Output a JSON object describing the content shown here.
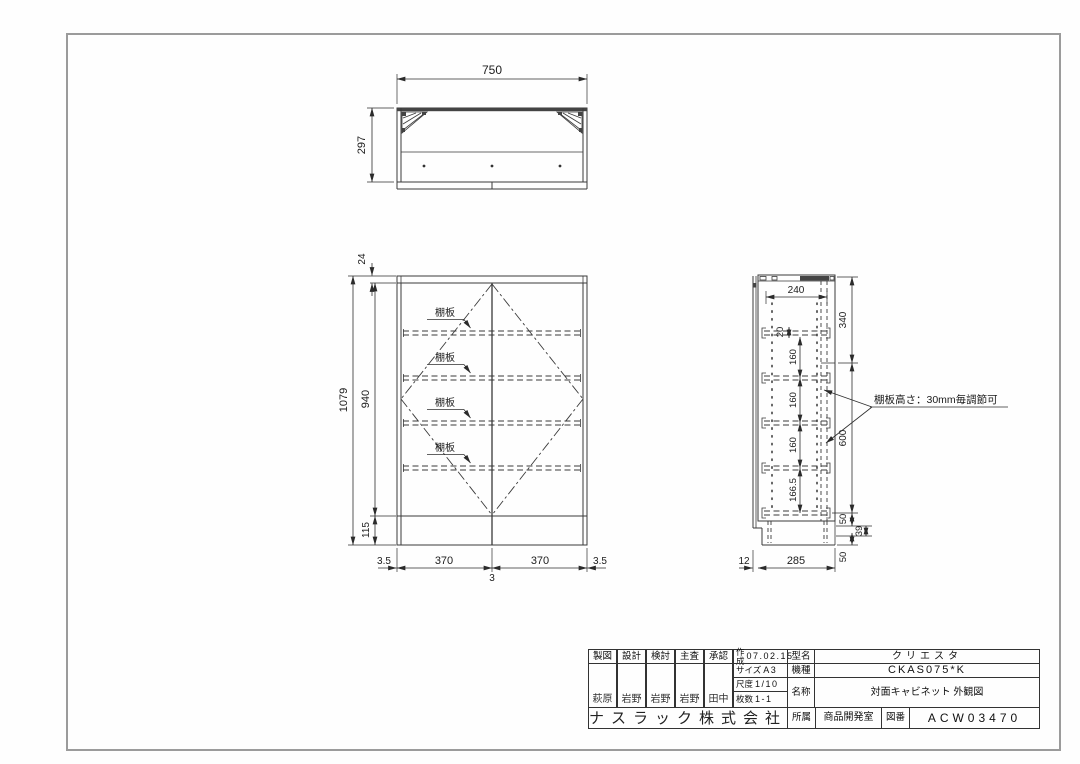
{
  "dims": {
    "top": {
      "w": "750",
      "d": "297"
    },
    "front": {
      "cap": "24",
      "total": "1079",
      "inner": "940",
      "base": "115",
      "edge_l": "3.5",
      "door_l": "370",
      "door_r": "370",
      "edge_r": "3.5",
      "gap": "3"
    },
    "side": {
      "inner_w": "240",
      "upper": "340",
      "pin": "20",
      "p1": "160",
      "p2": "160",
      "p3": "160",
      "p4": "166.5",
      "mid": "600",
      "b1": "50",
      "b2": "39",
      "b3": "50",
      "front_t": "12",
      "depth": "285"
    }
  },
  "labels": {
    "shelf": "棚板",
    "note": "棚板高さ：30mm毎調節可"
  },
  "title_block": {
    "roles": [
      "製図",
      "設計",
      "検討",
      "主査",
      "承認"
    ],
    "names": [
      "萩原",
      "岩野",
      "岩野",
      "岩野",
      "田中"
    ],
    "created_label": "作成",
    "created_date": "07.02.15",
    "size_label": "サイズ",
    "size_value": "A3",
    "scale_label": "尺度",
    "scale_value": "1/10",
    "sheets_label": "枚数",
    "sheets_value": "1-1",
    "model_label": "型名",
    "model_value": "クリエスタ",
    "type_label": "機種",
    "type_value": "CKAS075*K",
    "name_label": "名称",
    "name_value": "対面キャビネット 外観図",
    "company": "ナスラック株式会社",
    "dept_label": "所属",
    "dept_value": "商品開発室",
    "dwg_label": "図番",
    "dwg_value": "ACW03470"
  }
}
